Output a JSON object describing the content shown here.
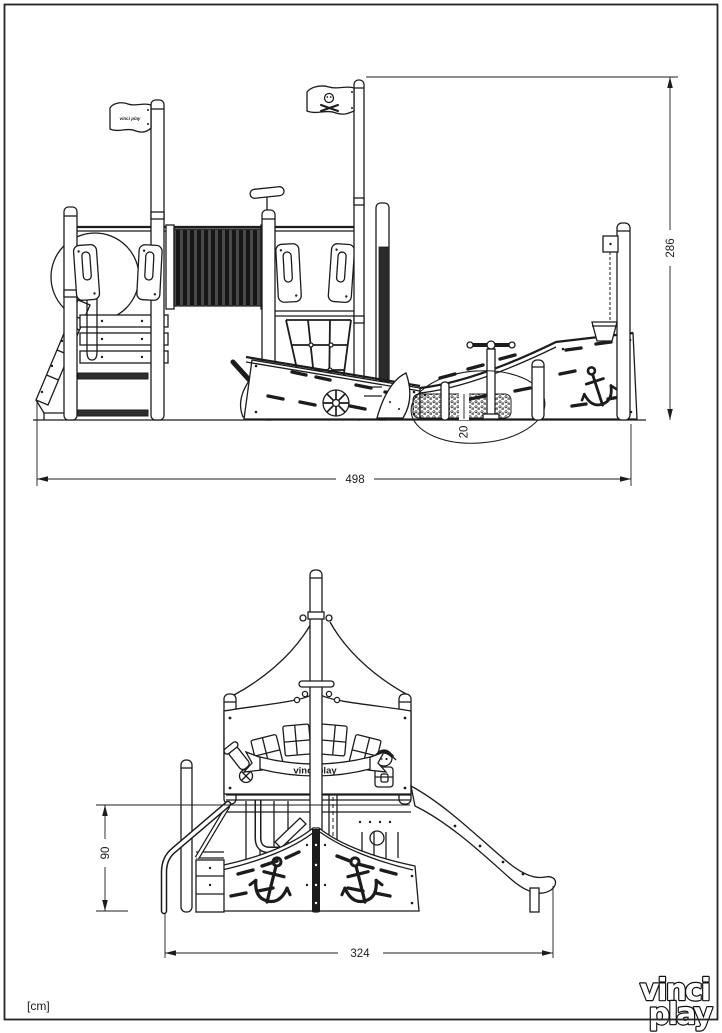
{
  "page": {
    "units_label": "[cm]",
    "logo": {
      "line1": "vinci",
      "line2": "play"
    }
  },
  "side_view": {
    "dim_total_width": "498",
    "dim_total_height": "286",
    "dim_sand_depth": "20",
    "flag_text": "vinci play"
  },
  "front_view": {
    "dim_total_width": "324",
    "dim_platform_height": "90",
    "banner_text": "vinci play"
  },
  "colors": {
    "line": "#1c1c1c",
    "background": "#ffffff",
    "tunnel_dark": "#4a4a4a"
  }
}
